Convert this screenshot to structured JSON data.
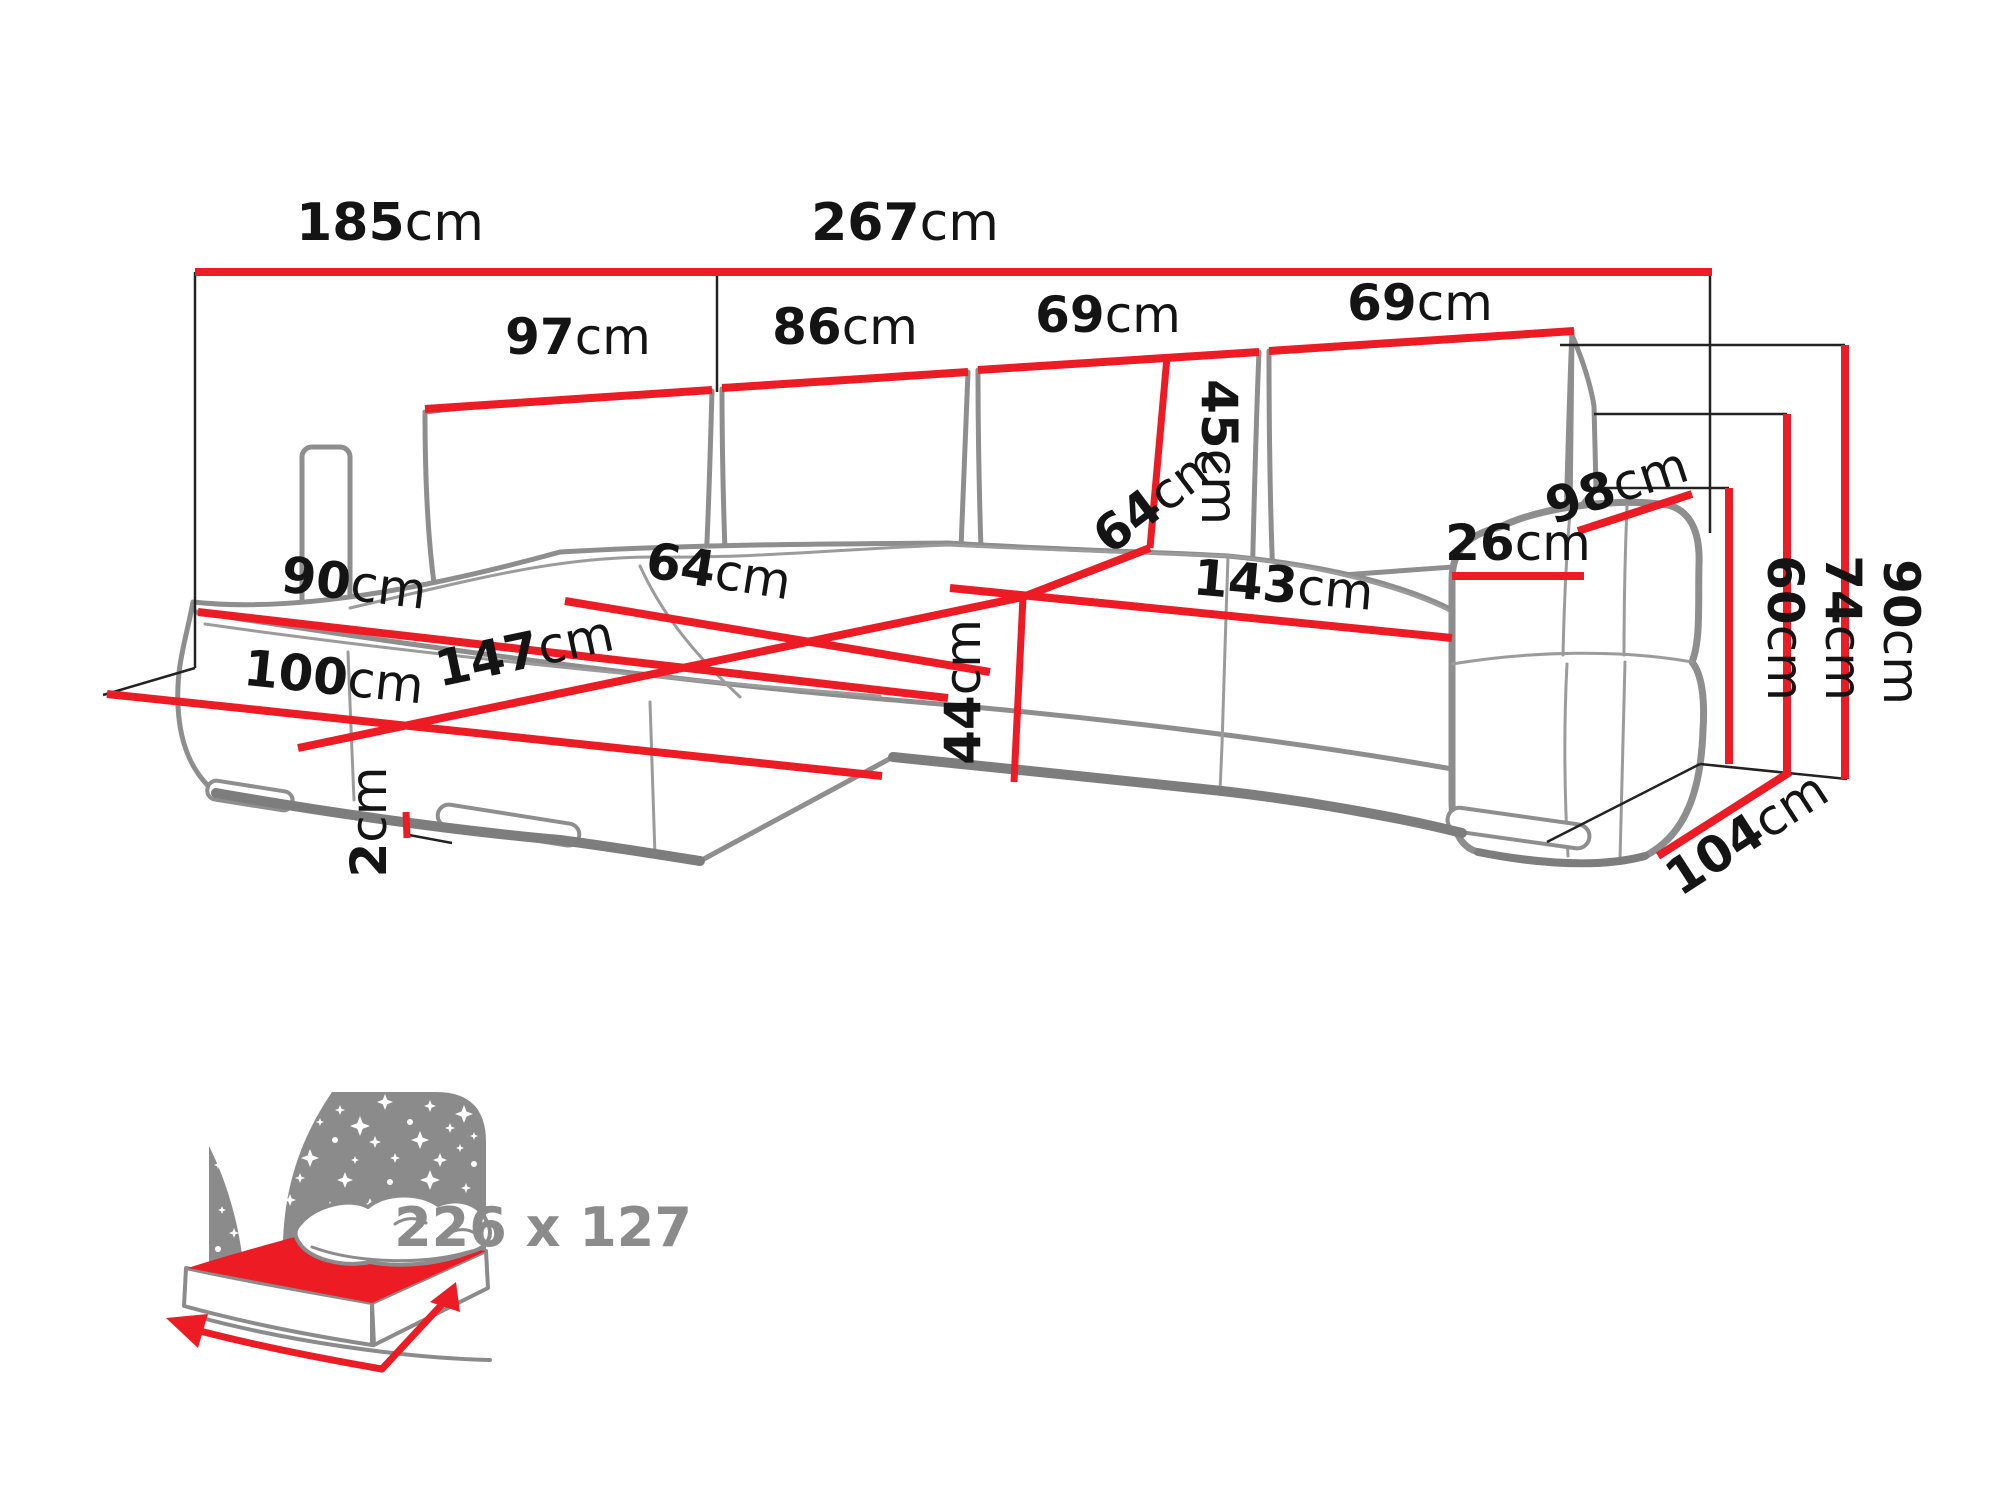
{
  "colors": {
    "dimension_red": "#ec1b24",
    "sketch_gray": "#8e8e8e",
    "label_black": "#141414",
    "icon_gray": "#8b8b8b",
    "background": "#ffffff"
  },
  "labels": {
    "overall_width_left": {
      "value": "185",
      "unit": "cm"
    },
    "overall_width_right": {
      "value": "267",
      "unit": "cm"
    },
    "backrest_segment_1": {
      "value": "97",
      "unit": "cm"
    },
    "backrest_segment_2": {
      "value": "86",
      "unit": "cm"
    },
    "backrest_segment_3": {
      "value": "69",
      "unit": "cm"
    },
    "backrest_segment_4": {
      "value": "69",
      "unit": "cm"
    },
    "backrest_cushion_height": {
      "value": "45",
      "unit": "cm"
    },
    "chaise_seat_width": {
      "value": "64",
      "unit": "cm"
    },
    "chaise_length": {
      "value": "147",
      "unit": "cm"
    },
    "seat_depth": {
      "value": "64",
      "unit": "cm"
    },
    "seat_width": {
      "value": "143",
      "unit": "cm"
    },
    "seat_height": {
      "value": "44",
      "unit": "cm"
    },
    "chaise_front_width": {
      "value": "90",
      "unit": "cm"
    },
    "chaise_total_length": {
      "value": "100",
      "unit": "cm"
    },
    "leg_height": {
      "value": "2",
      "unit": "cm"
    },
    "armrest_width": {
      "value": "26",
      "unit": "cm"
    },
    "armrest_depth": {
      "value": "98",
      "unit": "cm"
    },
    "seat_floor_height": {
      "value": "60",
      "unit": "cm"
    },
    "armrest_height": {
      "value": "74",
      "unit": "cm"
    },
    "total_height": {
      "value": "90",
      "unit": "cm"
    },
    "total_depth": {
      "value": "104",
      "unit": "cm"
    }
  },
  "sleeping_area": {
    "label": "226 x 127"
  }
}
